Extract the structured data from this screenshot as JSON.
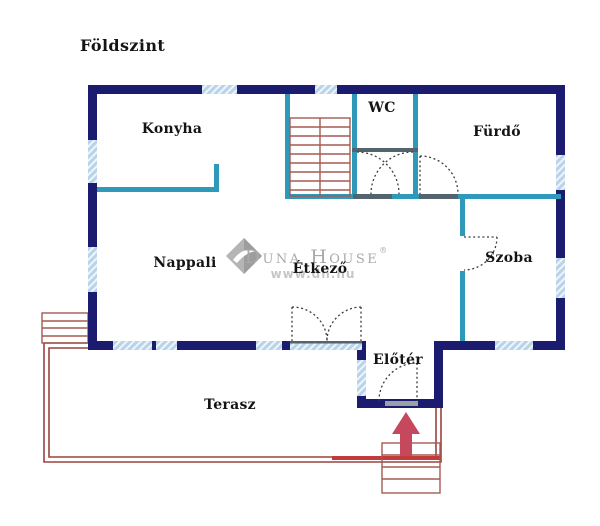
{
  "title": "Földszint",
  "rooms": {
    "konyha": "Konyha",
    "wc": "WC",
    "furdo": "Fürdő",
    "nappali": "Nappali",
    "etkezo": "Étkező",
    "szoba": "Szoba",
    "eloter": "Előtér",
    "terasz": "Terasz"
  },
  "watermark": {
    "brand": "Duna House",
    "registered": "®",
    "website": "www.dh.hu"
  },
  "colors": {
    "outer_wall": "#1b1b6f",
    "inner_wall": "#2e99b8",
    "window_fill": "#b9d3e9",
    "door_opening": "#54646e",
    "stairs": "#a65a52",
    "terrace": "#9a443f",
    "entrance_marker": "#c5485c",
    "label_text": "#141414",
    "watermark_gray": "#a9a9a9"
  }
}
